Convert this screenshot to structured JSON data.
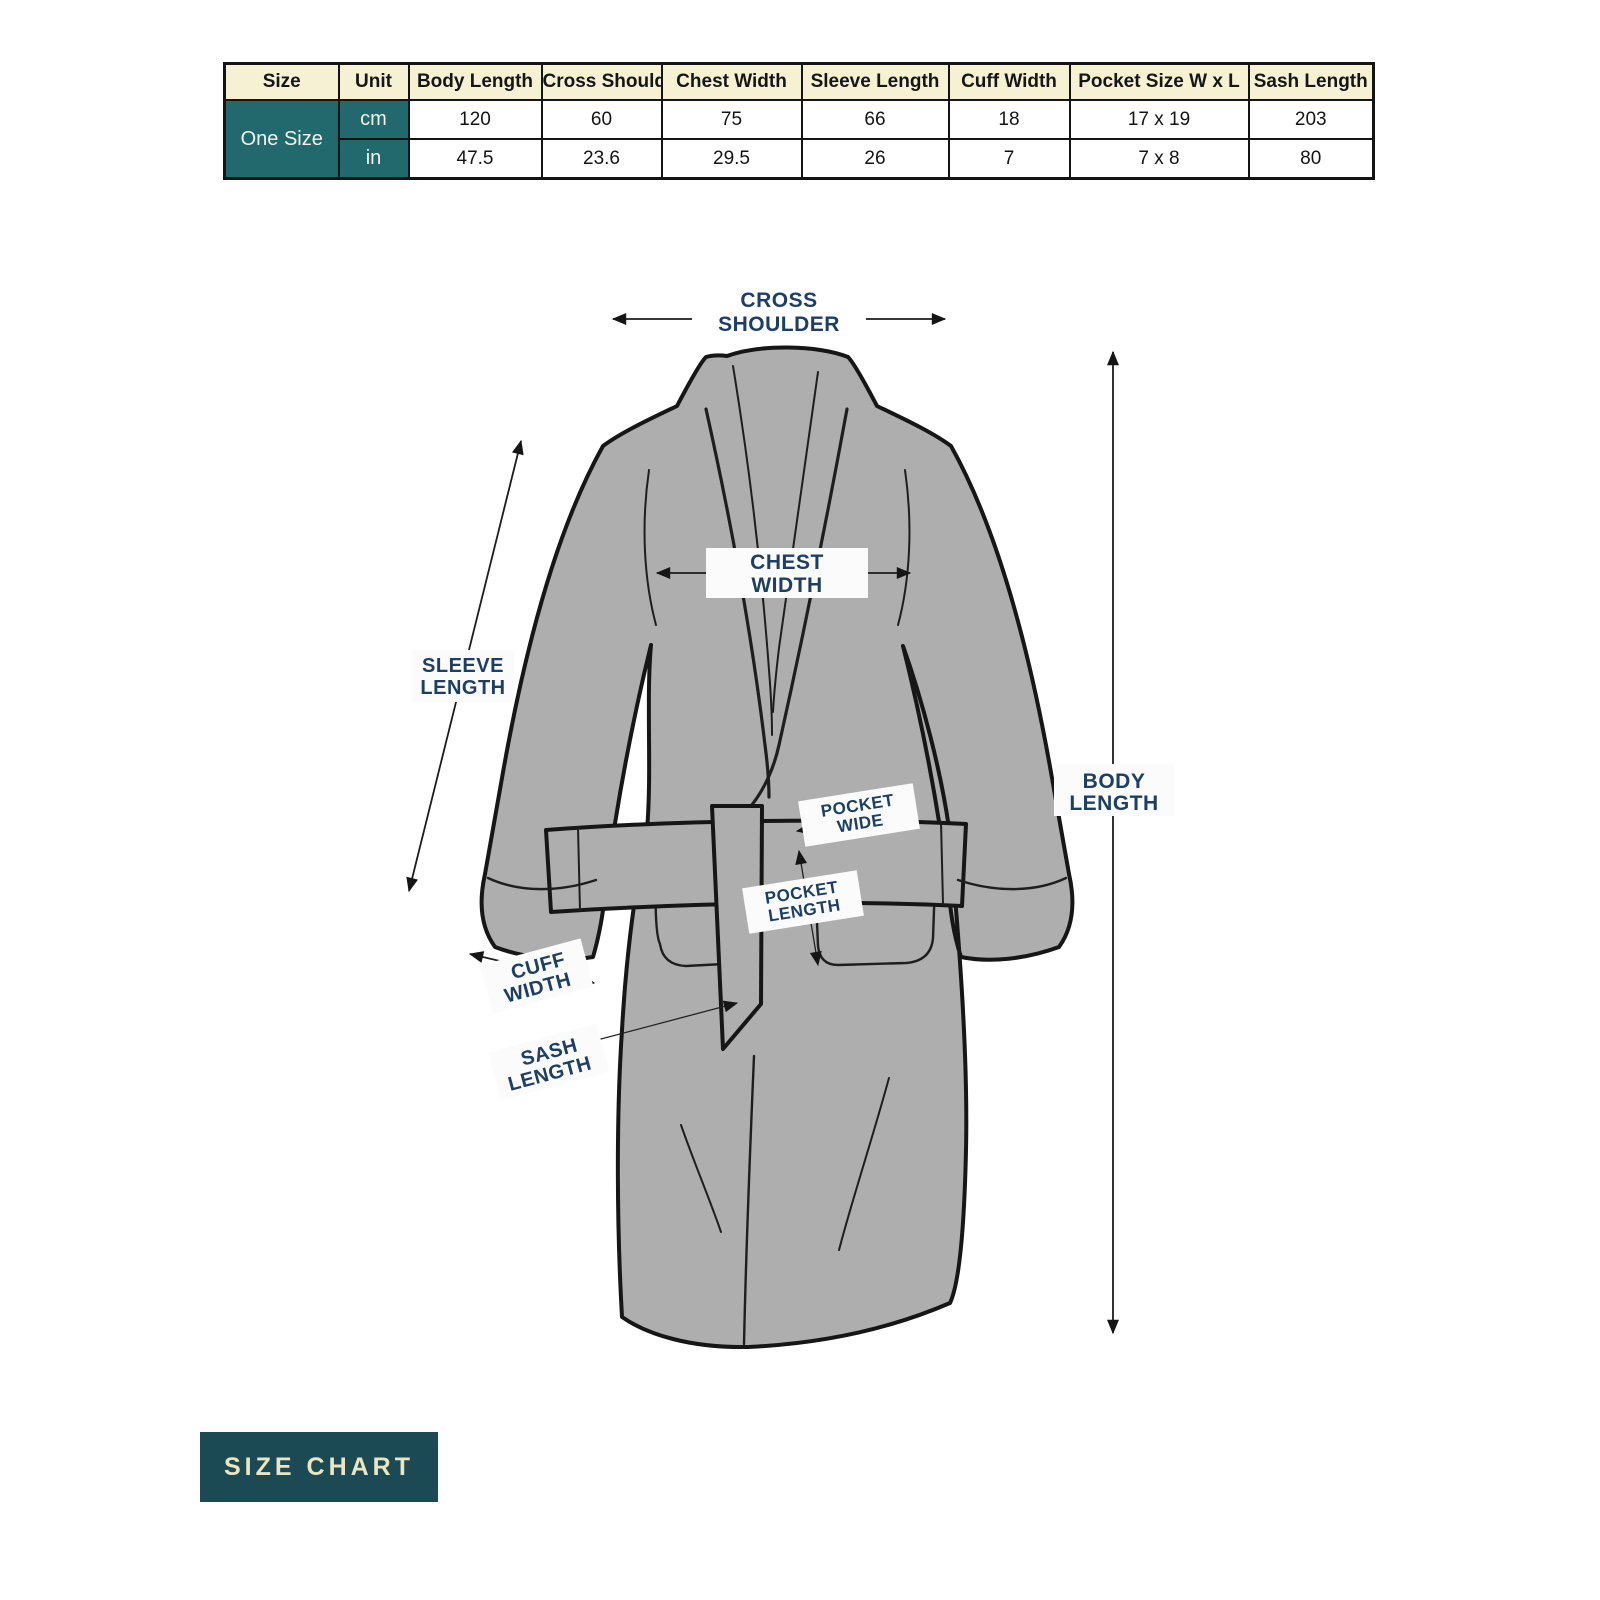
{
  "table": {
    "headers": [
      "Size",
      "Unit",
      "Body Length",
      "Cross Shoulder",
      "Chest Width",
      "Sleeve Length",
      "Cuff Width",
      "Pocket Size W x L",
      "Sash Length"
    ],
    "size_label": "One Size",
    "rows": [
      {
        "unit": "cm",
        "values": [
          "120",
          "60",
          "75",
          "66",
          "18",
          "17 x 19",
          "203"
        ]
      },
      {
        "unit": "in",
        "values": [
          "47.5",
          "23.6",
          "29.5",
          "26",
          "7",
          "7 x 8",
          "80"
        ]
      }
    ]
  },
  "diagram": {
    "labels": {
      "cross_shoulder": {
        "line1": "CROSS",
        "line2": "SHOULDER"
      },
      "chest_width": {
        "line1": "CHEST",
        "line2": "WIDTH"
      },
      "sleeve_length": {
        "line1": "SLEEVE",
        "line2": "LENGTH"
      },
      "body_length": {
        "line1": "BODY",
        "line2": "LENGTH"
      },
      "cuff_width": {
        "line1": "CUFF",
        "line2": "WIDTH"
      },
      "sash_length": {
        "line1": "SASH",
        "line2": "LENGTH"
      },
      "pocket_wide": {
        "line1": "POCKET",
        "line2": "WIDE"
      },
      "pocket_length": {
        "line1": "POCKET",
        "line2": "LENGTH"
      }
    }
  },
  "footer": {
    "badge": "SIZE CHART"
  },
  "colors": {
    "teal": "#21696c",
    "teal-dark": "#1c4a54",
    "cream": "#f6f1d3",
    "navy": "#1d3f63",
    "robe-gray": "#aeaeae",
    "outline": "#161616",
    "badge-text": "#ece5c1"
  }
}
